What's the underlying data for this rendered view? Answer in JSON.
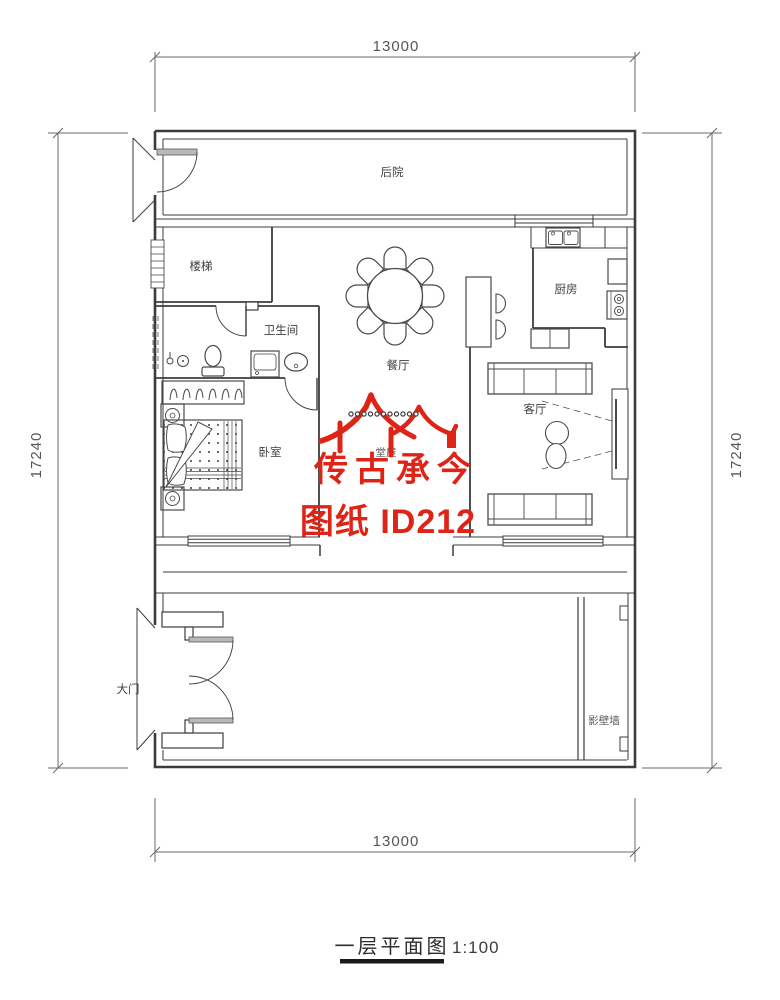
{
  "title": {
    "text": "一层平面图",
    "scale": "1:100"
  },
  "dimensions": {
    "width_top": "13000",
    "width_bottom": "13000",
    "height_left": "17240",
    "height_right": "17240"
  },
  "rooms": {
    "backyard": {
      "label": "后院"
    },
    "stairs": {
      "label": "楼梯"
    },
    "bathroom": {
      "label": "卫生间"
    },
    "kitchen": {
      "label": "厨房"
    },
    "dining": {
      "label": "餐厅"
    },
    "hall": {
      "label": "堂屋"
    },
    "bedroom": {
      "label": "卧室"
    },
    "living": {
      "label": "客厅"
    },
    "main_gate": {
      "label": "大门"
    },
    "screen_wall": {
      "label": "影壁墙"
    }
  },
  "watermark": {
    "brand": "传古承今",
    "sheet": "图纸 ID212",
    "color": "#de2417"
  },
  "colors": {
    "wall": "#3c3c3c",
    "furniture": "#4a4a4a",
    "dimension": "#6a6a6a",
    "background": "#ffffff"
  }
}
